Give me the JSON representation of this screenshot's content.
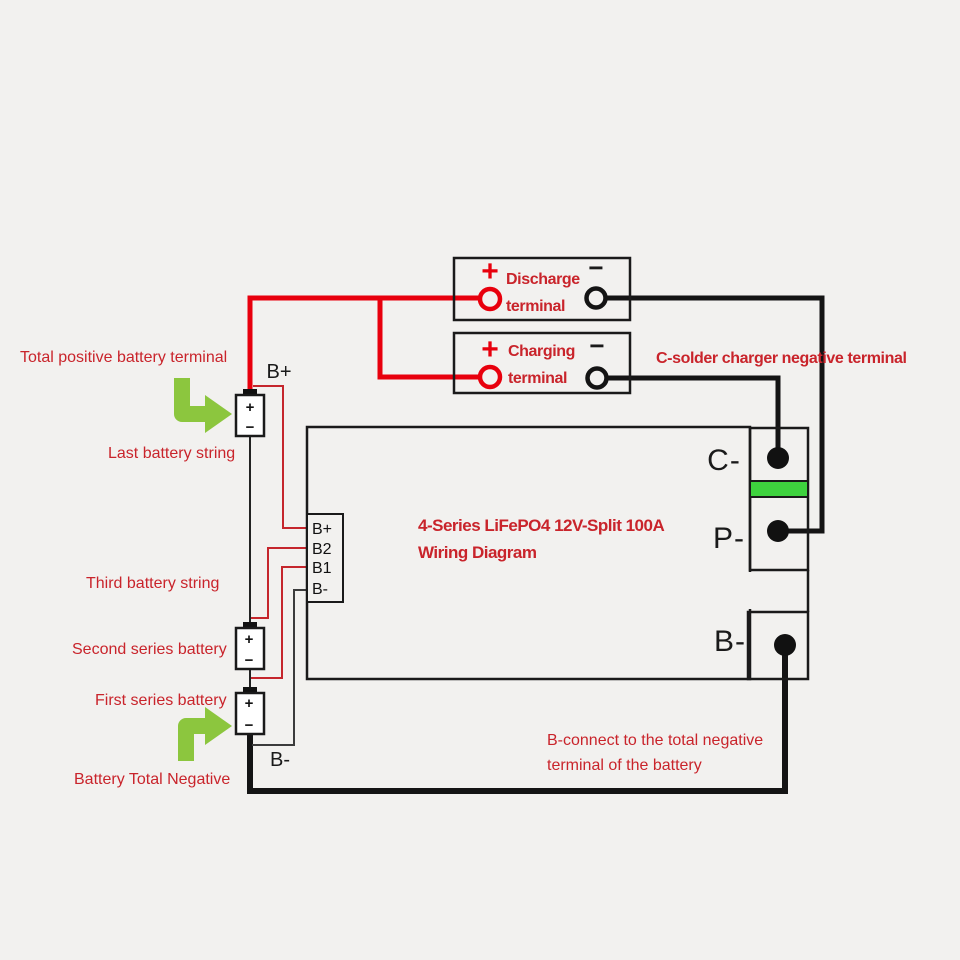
{
  "colors": {
    "background": "#f2f1ef",
    "wire_red": "#e8000d",
    "wire_black": "#141414",
    "signal_red": "#c5262c",
    "signal_dark": "#3c3c3c",
    "text_red": "#c9242b",
    "line_black": "#1a1a1a",
    "green_arrow": "#8cc63e",
    "green_bar": "#3ed23e",
    "dot_black": "#111111"
  },
  "title": {
    "line1": "4-Series LiFePO4 12V-Split 100A",
    "line2": "Wiring Diagram"
  },
  "discharge_terminal": {
    "plus": "+",
    "minus": "−",
    "name_line1": "Discharge",
    "name_line2": "terminal"
  },
  "charging_terminal": {
    "plus": "+",
    "minus": "−",
    "name_line1": "Charging",
    "name_line2": "terminal"
  },
  "bms": {
    "pad_c": "C-",
    "pad_p": "P-",
    "pad_b": "B-",
    "ports": [
      "B+",
      "B2",
      "B1",
      "B-"
    ]
  },
  "battery_labels": {
    "plus": "+",
    "minus": "−"
  },
  "annotations": {
    "total_positive": "Total positive battery terminal",
    "b_plus": "B+",
    "last_battery": "Last battery string",
    "third_battery": "Third battery string",
    "second_battery": "Second series battery",
    "first_battery": "First series battery",
    "battery_total_negative": "Battery Total Negative",
    "b_minus": "B-",
    "c_solder": "C-solder charger negative terminal",
    "b_connect_line1": "B-connect to the total negative",
    "b_connect_line2": "terminal of the battery"
  }
}
